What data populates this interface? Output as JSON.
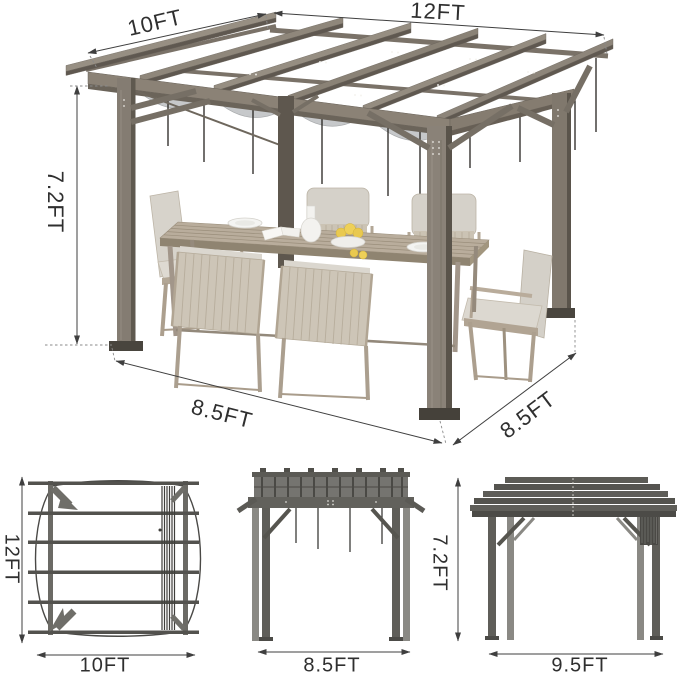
{
  "main_view": {
    "labels": {
      "depth": "10FT",
      "width": "12FT",
      "height": "7.2FT",
      "base_left": "8.5FT",
      "base_right": "8.5FT"
    }
  },
  "bottom_views": {
    "top_view": {
      "depth": "12FT",
      "width": "10FT"
    },
    "front_view": {
      "width": "8.5FT",
      "height": "7.2FT"
    },
    "side_view": {
      "width": "9.5FT"
    }
  },
  "colors": {
    "background": "#ffffff",
    "wood_light": "#978f83",
    "wood_mid": "#8b8276",
    "wood_dark": "#605950",
    "canopy_gray": "#c6c8ca",
    "metal_dark": "#5b5a55",
    "metal_mid": "#757470",
    "dimension_line": "#3f3f3f",
    "label_text": "#2f2f2f",
    "cushion": "#d7d3cb",
    "chair_frame": "#b3a796",
    "table_wood": "#b9ad9c",
    "lemon_yellow": "#e9c94f"
  }
}
